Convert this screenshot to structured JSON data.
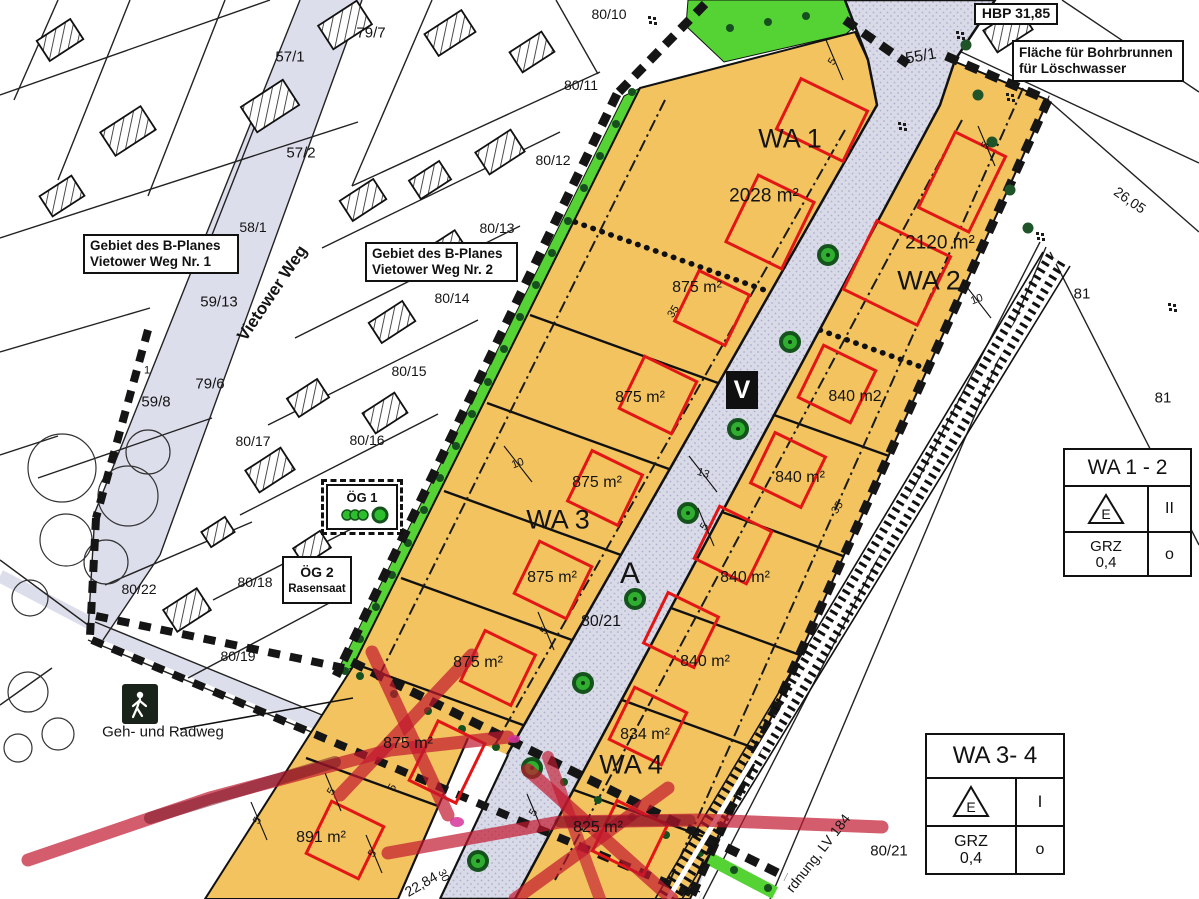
{
  "colors": {
    "plot_orange": "#F3C360",
    "road_lavender": "#D9DAE8",
    "green_strip": "#55D335",
    "red_envelope": "#E31616",
    "marker_red": "#C2182F",
    "tree_green": "#2FAE2F"
  },
  "boxes": {
    "hbp": {
      "label": "HBP 31,85"
    },
    "bohrbrunnen": {
      "line1": "Fläche für Bohrbrunnen",
      "line2": "für Löschwasser"
    },
    "gebiet1": {
      "line1": "Gebiet des B-Planes",
      "line2": "Vietower Weg Nr. 1"
    },
    "gebiet2": {
      "line1": "Gebiet des B-Planes",
      "line2": "Vietower Weg Nr. 2"
    },
    "og1": {
      "label": "ÖG 1"
    },
    "og2": {
      "line1": "ÖG 2",
      "line2": "Rasensaat"
    }
  },
  "signs": {
    "v": "V"
  },
  "legends": {
    "wa12": {
      "title": "WA 1 - 2",
      "symbol_letter": "E",
      "floors": "II",
      "grz_line1": "GRZ",
      "grz_line2": "0,4",
      "open_symbol": "o"
    },
    "wa34": {
      "title": "WA 3- 4",
      "symbol_letter": "E",
      "floors": "I",
      "grz_line1": "GRZ",
      "grz_line2": "0,4",
      "open_symbol": "o"
    }
  },
  "map": {
    "labels": [
      {
        "name": "parcel-80-10",
        "text": "80/10",
        "x": 609,
        "y": 14,
        "fs": 14
      },
      {
        "name": "parcel-79-7",
        "text": "79/7",
        "x": 371,
        "y": 33,
        "fs": 15
      },
      {
        "name": "parcel-54",
        "text": "54",
        "x": 1139,
        "y": 50,
        "fs": 16
      },
      {
        "name": "parcel-57-1",
        "text": "57/1",
        "x": 290,
        "y": 57,
        "fs": 15
      },
      {
        "name": "parcel-80-11",
        "text": "80/11",
        "x": 581,
        "y": 85,
        "fs": 14
      },
      {
        "name": "parcel-55-1",
        "text": "55/1",
        "x": 921,
        "y": 57,
        "fs": 16,
        "rot": -10
      },
      {
        "name": "parcel-57-2",
        "text": "57/2",
        "x": 301,
        "y": 153,
        "fs": 15
      },
      {
        "name": "parcel-80-12",
        "text": "80/12",
        "x": 553,
        "y": 160,
        "fs": 14
      },
      {
        "name": "parcel-58-1",
        "text": "58/1",
        "x": 253,
        "y": 227,
        "fs": 14
      },
      {
        "name": "parcel-80-13",
        "text": "80/13",
        "x": 497,
        "y": 228,
        "fs": 14
      },
      {
        "name": "parcel-59-13",
        "text": "59/13",
        "x": 219,
        "y": 302,
        "fs": 15
      },
      {
        "name": "parcel-80-14",
        "text": "80/14",
        "x": 452,
        "y": 298,
        "fs": 14
      },
      {
        "name": "street-vietower-weg",
        "text": "Vietower Weg",
        "x": 272,
        "y": 293,
        "fs": 17,
        "rot": -56,
        "fw": 700
      },
      {
        "name": "parcel-79-6",
        "text": "79/6",
        "x": 210,
        "y": 384,
        "fs": 15
      },
      {
        "name": "parcel-80-15",
        "text": "80/15",
        "x": 409,
        "y": 371,
        "fs": 14
      },
      {
        "name": "parcel-59-8",
        "text": "59/8",
        "x": 156,
        "y": 402,
        "fs": 15
      },
      {
        "name": "parcel-1",
        "text": "1",
        "x": 147,
        "y": 371,
        "fs": 11
      },
      {
        "name": "parcel-80-17",
        "text": "80/17",
        "x": 253,
        "y": 441,
        "fs": 14
      },
      {
        "name": "parcel-80-16",
        "text": "80/16",
        "x": 367,
        "y": 440,
        "fs": 14
      },
      {
        "name": "parcel-80-18",
        "text": "80/18",
        "x": 255,
        "y": 582,
        "fs": 14
      },
      {
        "name": "parcel-80-22",
        "text": "80/22",
        "x": 139,
        "y": 589,
        "fs": 14
      },
      {
        "name": "parcel-80-19",
        "text": "80/19",
        "x": 238,
        "y": 656,
        "fs": 14
      },
      {
        "name": "label-geh-und-radweg",
        "text": "Geh- und Radweg",
        "x": 163,
        "y": 732,
        "fs": 15
      },
      {
        "name": "area-891",
        "text": "891 m²",
        "x": 321,
        "y": 838,
        "fs": 16
      },
      {
        "name": "dim-22-84",
        "text": "22,84",
        "x": 421,
        "y": 884,
        "fs": 14,
        "rot": -30
      },
      {
        "name": "dim-30",
        "text": "30",
        "x": 443,
        "y": 876,
        "fs": 11,
        "rot": 62
      },
      {
        "name": "zone-wa1",
        "text": "WA 1",
        "x": 790,
        "y": 139,
        "fs": 27
      },
      {
        "name": "area-2028",
        "text": "2028 m²",
        "x": 764,
        "y": 196,
        "fs": 19
      },
      {
        "name": "zone-wa2",
        "text": "WA 2",
        "x": 929,
        "y": 281,
        "fs": 27
      },
      {
        "name": "area-2120",
        "text": "2120 m²",
        "x": 940,
        "y": 243,
        "fs": 19
      },
      {
        "name": "zone-wa3",
        "text": "WA 3",
        "x": 558,
        "y": 520,
        "fs": 27
      },
      {
        "name": "zone-wa4",
        "text": "WA 4",
        "x": 631,
        "y": 765,
        "fs": 27
      },
      {
        "name": "area-875-1",
        "text": "875 m²",
        "x": 697,
        "y": 288,
        "fs": 16
      },
      {
        "name": "area-875-2",
        "text": "875 m²",
        "x": 640,
        "y": 398,
        "fs": 16
      },
      {
        "name": "area-875-3",
        "text": "875 m²",
        "x": 597,
        "y": 483,
        "fs": 16
      },
      {
        "name": "area-875-4",
        "text": "875 m²",
        "x": 552,
        "y": 578,
        "fs": 16
      },
      {
        "name": "area-875-5",
        "text": "875 m²",
        "x": 478,
        "y": 663,
        "fs": 16
      },
      {
        "name": "area-875-6",
        "text": "875 m²",
        "x": 408,
        "y": 744,
        "fs": 16
      },
      {
        "name": "area-840-1",
        "text": "840 m2",
        "x": 855,
        "y": 397,
        "fs": 16
      },
      {
        "name": "area-840-2",
        "text": "840 m²",
        "x": 800,
        "y": 478,
        "fs": 16
      },
      {
        "name": "area-840-3",
        "text": "840 m²",
        "x": 745,
        "y": 578,
        "fs": 16
      },
      {
        "name": "area-840-4",
        "text": "840 m²",
        "x": 705,
        "y": 662,
        "fs": 16
      },
      {
        "name": "area-834",
        "text": "834 m²",
        "x": 645,
        "y": 735,
        "fs": 16
      },
      {
        "name": "area-825",
        "text": "825 m²",
        "x": 598,
        "y": 828,
        "fs": 16
      },
      {
        "name": "road-point-a",
        "text": "A",
        "x": 630,
        "y": 574,
        "fs": 30
      },
      {
        "name": "parcel-80-21-road",
        "text": "80/21",
        "x": 601,
        "y": 622,
        "fs": 16
      },
      {
        "name": "parcel-81-a",
        "text": "81",
        "x": 1082,
        "y": 294,
        "fs": 15
      },
      {
        "name": "parcel-81-b",
        "text": "81",
        "x": 1163,
        "y": 398,
        "fs": 15
      },
      {
        "name": "dim-26-05",
        "text": "26,05",
        "x": 1130,
        "y": 200,
        "fs": 14,
        "rot": 35
      },
      {
        "name": "parcel-80-21-br",
        "text": "80/21",
        "x": 889,
        "y": 851,
        "fs": 15
      },
      {
        "name": "label-lv-184",
        "text": "rdnung, LV 184",
        "x": 818,
        "y": 853,
        "fs": 14,
        "rot": -52
      },
      {
        "name": "dim-35-a",
        "text": "35",
        "x": 674,
        "y": 312,
        "fs": 11,
        "rot": -57
      },
      {
        "name": "dim-35-b",
        "text": "35",
        "x": 838,
        "y": 508,
        "fs": 11,
        "rot": -57
      },
      {
        "name": "dim-10-a",
        "text": "10",
        "x": 518,
        "y": 464,
        "fs": 11,
        "rot": -20
      },
      {
        "name": "dim-10-b",
        "text": "10",
        "x": 977,
        "y": 300,
        "fs": 11,
        "rot": -20
      },
      {
        "name": "dim-13",
        "text": "13",
        "x": 703,
        "y": 474,
        "fs": 11,
        "rot": 18
      },
      {
        "name": "dim-5-a",
        "text": "5",
        "x": 833,
        "y": 62,
        "fs": 11,
        "rot": -57
      },
      {
        "name": "dim-5-b",
        "text": "5",
        "x": 986,
        "y": 146,
        "fs": 11,
        "rot": -57
      },
      {
        "name": "dim-5-c",
        "text": "5",
        "x": 705,
        "y": 527,
        "fs": 11,
        "rot": -57
      },
      {
        "name": "dim-5-d",
        "text": "5",
        "x": 545,
        "y": 631,
        "fs": 11,
        "rot": -57
      },
      {
        "name": "dim-5-e",
        "text": "5",
        "x": 332,
        "y": 792,
        "fs": 11,
        "rot": -57
      },
      {
        "name": "dim-5-f",
        "text": "5",
        "x": 393,
        "y": 788,
        "fs": 11,
        "rot": -57
      },
      {
        "name": "dim-5-g",
        "text": "5",
        "x": 258,
        "y": 821,
        "fs": 11,
        "rot": -57
      },
      {
        "name": "dim-5-h",
        "text": "5",
        "x": 373,
        "y": 854,
        "fs": 11,
        "rot": -57
      },
      {
        "name": "dim-5-i",
        "text": "5",
        "x": 534,
        "y": 813,
        "fs": 11,
        "rot": -57
      }
    ]
  }
}
